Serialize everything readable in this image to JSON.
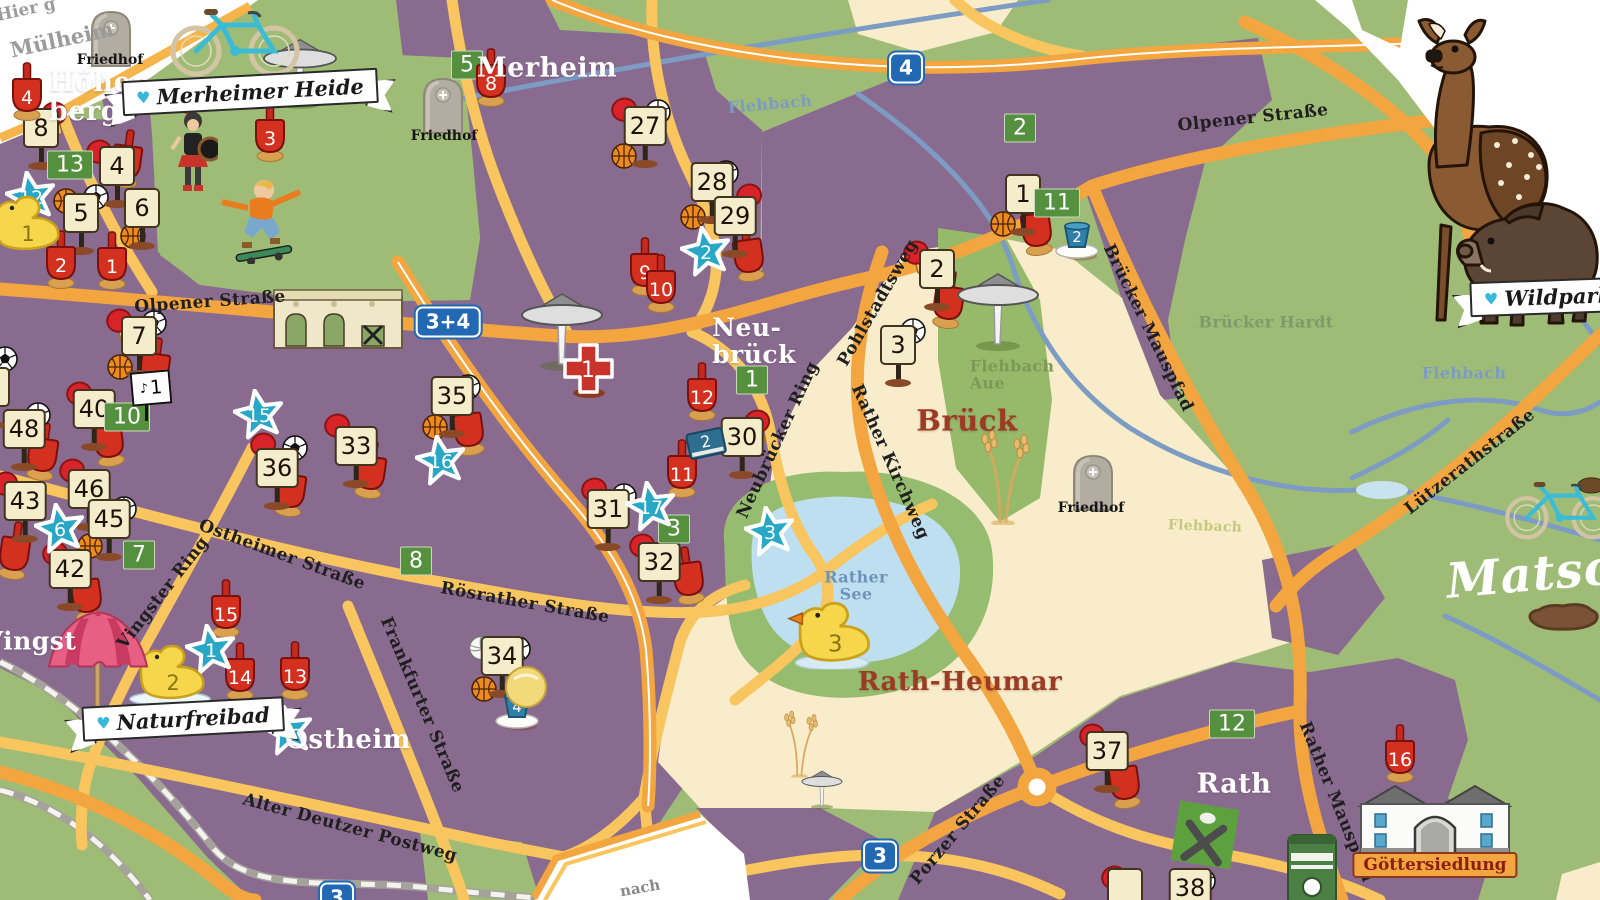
{
  "colors": {
    "urban_purple": "#8a6b90",
    "park_green": "#9fbc77",
    "field_cream": "#f8ecca",
    "road_main": "#f3a53f",
    "road_light": "#f8c55e",
    "stream_blue": "#7d9cc4",
    "lake_blue": "#bedff0",
    "star_blue": "#29a7c7",
    "sign_beige": "#f3edcb",
    "badge_green": "#55903f",
    "shovel_red": "#d3301f",
    "autobahn_blue": "#2268b3",
    "label_red": "#9c3a22"
  },
  "labels": {
    "districts": [
      {
        "text": "Höhen-\nberg",
        "x": 106,
        "y": 97,
        "color": "#ffffff",
        "size": 27,
        "rot": 0,
        "align": "left"
      },
      {
        "text": "Merheim",
        "x": 547,
        "y": 68,
        "color": "#ffffff",
        "size": 27,
        "rot": 0
      },
      {
        "text": "Neu-\nbrück",
        "x": 754,
        "y": 341,
        "color": "#ffffff",
        "size": 25,
        "rot": 0,
        "align": "left"
      },
      {
        "text": "Vingst",
        "x": 30,
        "y": 641,
        "color": "#ffffff",
        "size": 25,
        "rot": 0
      },
      {
        "text": "Ostheim",
        "x": 348,
        "y": 740,
        "color": "#ffffff",
        "size": 26,
        "rot": 0
      },
      {
        "text": "Rath",
        "x": 1234,
        "y": 784,
        "color": "#ffffff",
        "size": 27,
        "rot": 0
      },
      {
        "text": "Brück",
        "x": 967,
        "y": 421,
        "color": "#9c3a22",
        "size": 29,
        "rot": 0
      },
      {
        "text": "Rath-Heumar",
        "x": 960,
        "y": 682,
        "color": "#9c3a22",
        "size": 26,
        "rot": 0
      }
    ],
    "streets": [
      {
        "text": "Olpener Straße",
        "x": 210,
        "y": 302,
        "rot": -4
      },
      {
        "text": "Olpener Straße",
        "x": 1253,
        "y": 118,
        "rot": -6
      },
      {
        "text": "Ostheimer Straße",
        "x": 282,
        "y": 555,
        "rot": 20
      },
      {
        "text": "Rösrather Straße",
        "x": 525,
        "y": 603,
        "rot": 10
      },
      {
        "text": "Frankfurter Straße",
        "x": 422,
        "y": 705,
        "rot": 67
      },
      {
        "text": "Vingster Ring",
        "x": 163,
        "y": 593,
        "rot": -52
      },
      {
        "text": "Alter Deutzer Postweg",
        "x": 350,
        "y": 828,
        "rot": 15
      },
      {
        "text": "Pohlstadtsweg",
        "x": 878,
        "y": 303,
        "rot": -60
      },
      {
        "text": "Rather Kirchweg",
        "x": 890,
        "y": 462,
        "rot": 66
      },
      {
        "text": "Neubrücker Ring",
        "x": 778,
        "y": 440,
        "rot": -65
      },
      {
        "text": "Brücker Mauspfad",
        "x": 1148,
        "y": 328,
        "rot": 64
      },
      {
        "text": "Rather Mauspfad",
        "x": 1336,
        "y": 802,
        "rot": 68
      },
      {
        "text": "Porzer Straße",
        "x": 958,
        "y": 830,
        "rot": -50
      },
      {
        "text": "Lützerathstraße",
        "x": 1470,
        "y": 462,
        "rot": -38
      }
    ],
    "waters": [
      {
        "text": "Flehbach",
        "x": 770,
        "y": 104,
        "rot": -5,
        "color": "#7d9cc0",
        "size": 16
      },
      {
        "text": "Flehbach",
        "x": 1464,
        "y": 373,
        "rot": 0,
        "color": "#7d9cc0",
        "size": 16
      },
      {
        "text": "Flehbach",
        "x": 1205,
        "y": 527,
        "rot": 2,
        "color": "#c3ca7d",
        "size": 14
      },
      {
        "text": "Rather\nSee",
        "x": 856,
        "y": 586,
        "rot": 0,
        "color": "#6e93ba",
        "size": 16
      },
      {
        "text": "Flehbach\nAue",
        "x": 1012,
        "y": 375,
        "rot": 0,
        "color": "#7c9a55",
        "size": 16,
        "align": "left"
      },
      {
        "text": "Brücker Hardt",
        "x": 1266,
        "y": 322,
        "rot": 0,
        "color": "#7f9a6a",
        "size": 16
      }
    ],
    "edges": [
      {
        "text": "Hier g",
        "x": 26,
        "y": 10,
        "rot": -12,
        "color": "#9b9b9b",
        "size": 17
      },
      {
        "text": "Mülheim",
        "x": 62,
        "y": 40,
        "rot": -12,
        "color": "#9b9b9b",
        "size": 21
      },
      {
        "text": "nach",
        "x": 640,
        "y": 888,
        "rot": -10,
        "color": "#8a8a8a",
        "size": 15
      },
      {
        "text": "Matsch",
        "x": 1548,
        "y": 574,
        "rot": -5,
        "color": "#ffffff",
        "size": 48,
        "script": true
      }
    ]
  },
  "banners": [
    {
      "text": "Merheimer Heide",
      "x": 250,
      "y": 92,
      "rot": -3
    },
    {
      "text": "Naturfreibad",
      "x": 183,
      "y": 719,
      "rot": -3
    },
    {
      "text": "Wildpark",
      "x": 1548,
      "y": 297,
      "rot": -2
    }
  ],
  "road_badges": [
    {
      "text": "4",
      "x": 906,
      "y": 68
    },
    {
      "text": "3+4",
      "x": 448,
      "y": 322
    },
    {
      "text": "3",
      "x": 880,
      "y": 856
    },
    {
      "text": "3",
      "x": 337,
      "y": 898
    }
  ],
  "poi_badges": [
    {
      "text": "Göttersiedlung",
      "x": 1435,
      "y": 865
    }
  ],
  "cemeteries": [
    {
      "label": "Friedhof",
      "stone_x": 111,
      "stone_y": 36,
      "label_x": 110,
      "label_y": 60
    },
    {
      "label": "Friedhof",
      "stone_x": 443,
      "stone_y": 103,
      "label_x": 444,
      "label_y": 136
    },
    {
      "label": "Friedhof",
      "stone_x": 1093,
      "stone_y": 480,
      "label_x": 1091,
      "label_y": 508
    }
  ],
  "markers": {
    "signs": [
      [
        "8",
        41,
        139
      ],
      [
        "4",
        117,
        177
      ],
      [
        "5",
        81,
        224
      ],
      [
        "6",
        142,
        219
      ],
      [
        "27",
        645,
        137
      ],
      [
        "28",
        712,
        193
      ],
      [
        "29",
        735,
        227
      ],
      [
        "7",
        139,
        347
      ],
      [
        "40",
        94,
        420
      ],
      [
        "48",
        24,
        440
      ],
      [
        "36",
        277,
        479
      ],
      [
        "33",
        356,
        457
      ],
      [
        "35",
        452,
        407
      ],
      [
        "43",
        25,
        512
      ],
      [
        "46",
        89,
        500
      ],
      [
        "45",
        109,
        530
      ],
      [
        "42",
        70,
        580
      ],
      [
        "31",
        608,
        520
      ],
      [
        "32",
        659,
        573
      ],
      [
        "30",
        742,
        448
      ],
      [
        "2",
        937,
        280
      ],
      [
        "3",
        898,
        356
      ],
      [
        "34",
        502,
        667
      ],
      [
        "37",
        1107,
        762
      ],
      [
        "1",
        1023,
        205
      ],
      [
        "",
        -8,
        398
      ],
      [
        "",
        1125,
        899
      ],
      [
        "38",
        1190,
        899
      ]
    ],
    "green_badges": [
      [
        "13",
        70,
        165
      ],
      [
        "5",
        467,
        65
      ],
      [
        "2",
        1020,
        128
      ],
      [
        "11",
        1057,
        203
      ],
      [
        "10",
        127,
        417
      ],
      [
        "7",
        139,
        555
      ],
      [
        "8",
        416,
        561
      ],
      [
        "1",
        752,
        380
      ],
      [
        "3",
        674,
        529
      ],
      [
        "12",
        1232,
        724
      ]
    ],
    "stars": [
      [
        "12",
        32,
        198
      ],
      [
        "2",
        707,
        253
      ],
      [
        "15",
        260,
        416
      ],
      [
        "16",
        442,
        462
      ],
      [
        "6",
        61,
        530
      ],
      [
        "17",
        652,
        508
      ],
      [
        "3",
        771,
        533
      ],
      [
        "1",
        212,
        651
      ],
      [
        "4",
        289,
        732
      ]
    ],
    "shovels": [
      [
        "4",
        27,
        91
      ],
      [
        "3",
        270,
        132
      ],
      [
        "8",
        491,
        77
      ],
      [
        "2",
        61,
        259
      ],
      [
        "1",
        112,
        260
      ],
      [
        "9",
        645,
        266
      ],
      [
        "10",
        661,
        283
      ],
      [
        "12",
        702,
        391
      ],
      [
        "11",
        682,
        468
      ],
      [
        "15",
        226,
        608
      ],
      [
        "14",
        240,
        671
      ],
      [
        "13",
        295,
        670
      ],
      [
        "16",
        1400,
        753
      ]
    ],
    "plain_shovels": [
      [
        127,
        158
      ],
      [
        43,
        451
      ],
      [
        108,
        437
      ],
      [
        155,
        366
      ],
      [
        291,
        487
      ],
      [
        371,
        469
      ],
      [
        468,
        426
      ],
      [
        86,
        592
      ],
      [
        688,
        575
      ],
      [
        748,
        252
      ],
      [
        949,
        299
      ],
      [
        1036,
        226
      ],
      [
        1124,
        779
      ],
      [
        15,
        550
      ]
    ],
    "paddles": [
      [
        55,
        120
      ],
      [
        100,
        158
      ],
      [
        120,
        327
      ],
      [
        80,
        400
      ],
      [
        73,
        477
      ],
      [
        6,
        490
      ],
      [
        56,
        560
      ],
      [
        264,
        451
      ],
      [
        338,
        432
      ],
      [
        595,
        496
      ],
      [
        643,
        552
      ],
      [
        758,
        428
      ],
      [
        917,
        259
      ],
      [
        625,
        116
      ],
      [
        750,
        202
      ],
      [
        1093,
        742
      ],
      [
        1115,
        884
      ]
    ],
    "soccer_balls": [
      [
        96,
        197
      ],
      [
        658,
        112
      ],
      [
        726,
        173
      ],
      [
        5,
        359
      ],
      [
        38,
        415
      ],
      [
        124,
        509
      ],
      [
        154,
        323
      ],
      [
        295,
        448
      ],
      [
        468,
        387
      ],
      [
        624,
        496
      ],
      [
        913,
        331
      ],
      [
        518,
        649
      ],
      [
        1203,
        881
      ]
    ],
    "basketballs": [
      [
        66,
        201
      ],
      [
        133,
        236
      ],
      [
        120,
        367
      ],
      [
        624,
        156
      ],
      [
        693,
        217
      ],
      [
        435,
        427
      ],
      [
        90,
        546
      ],
      [
        484,
        689
      ],
      [
        1003,
        224
      ]
    ],
    "volleyballs": [
      [
        481,
        648
      ]
    ],
    "buckets": [
      [
        "2",
        1078,
        241
      ],
      [
        "4",
        518,
        711
      ]
    ],
    "ducks": [
      [
        "1",
        25,
        225,
        "plain"
      ],
      [
        "2",
        170,
        674,
        "pool"
      ],
      [
        "3",
        832,
        634,
        "splash"
      ]
    ],
    "books": [
      [
        "2",
        706,
        443
      ]
    ],
    "music_signs": [
      [
        "1",
        151,
        396
      ]
    ],
    "first_aid": [
      [
        "1",
        588,
        369
      ]
    ],
    "shelters": [
      [
        300,
        72,
        0.9
      ],
      [
        562,
        330,
        1
      ],
      [
        998,
        310,
        1
      ],
      [
        822,
        789,
        0.5
      ]
    ]
  }
}
